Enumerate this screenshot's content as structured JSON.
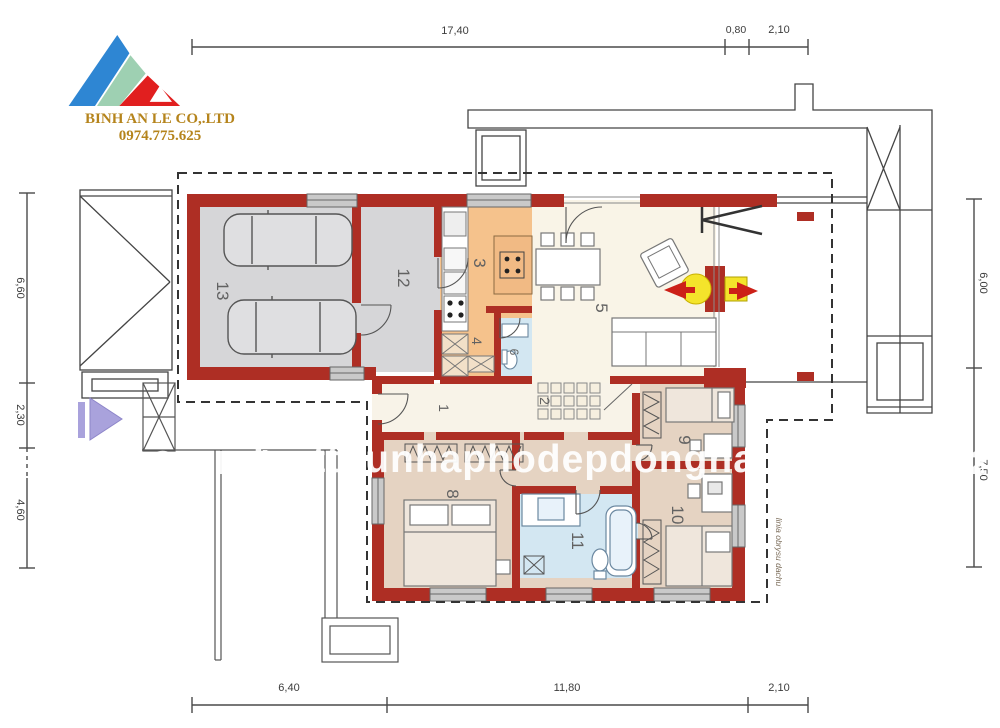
{
  "logo": {
    "company": "BINH AN LE CO,.LTD",
    "phone": "0974.775.625"
  },
  "watermark": {
    "part1": "Co.,Ltd -",
    "part2": "bietthunhaphodepdongnai.com",
    "part3": "- 0974.775.625"
  },
  "dims": {
    "top": [
      "17,40",
      "0,80",
      "2,10"
    ],
    "bottom": [
      "6,40",
      "11,80",
      "2,10"
    ],
    "left": [
      "6,60",
      "2,30",
      "4,60"
    ],
    "right": [
      "6,00",
      "7,50"
    ]
  },
  "rooms": {
    "r1": "1",
    "r2": "2",
    "r3": "3",
    "r4": "4",
    "r5": "5",
    "r6": "6",
    "r8": "8",
    "r9": "9",
    "r10": "10",
    "r11": "11",
    "r12": "12",
    "r13": "13"
  },
  "annotation": {
    "roof_line": "linia obrysu dachu"
  },
  "colors": {
    "wall_red": "#ae2e24",
    "garage_floor": "#d6d6d8",
    "kitchen_floor": "#f5c28c",
    "living_floor": "#f9f4e7",
    "bedroom_floor": "#e5d3c2",
    "bath_floor": "#d3e7f2",
    "fire_yellow": "#f4e42b",
    "arrow_purple": "#a9a2dc",
    "logo_gold": "#b5841c",
    "logo_blue": "#2e86d3",
    "logo_green": "#9ed0b2",
    "logo_red": "#e11f1f"
  }
}
